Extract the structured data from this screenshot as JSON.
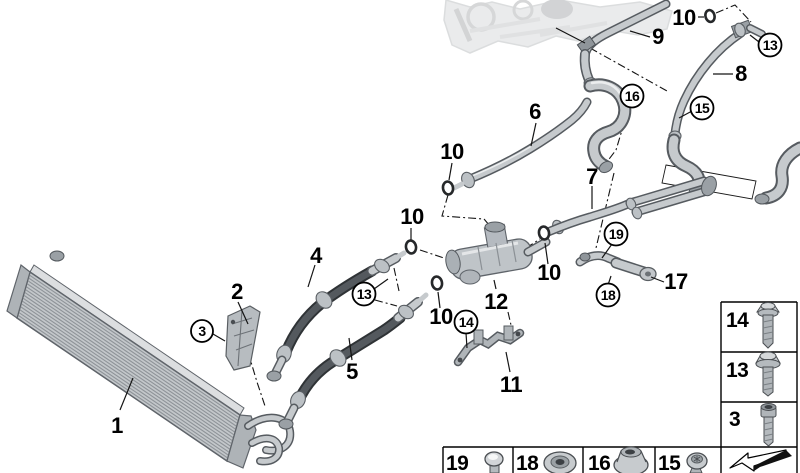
{
  "figure": {
    "kind": "vehicle-parts-exploded-diagram",
    "background_color": "#ffffff",
    "line_color": "#141414",
    "metal_color": "#c6cacd",
    "hose_color": "#54595e",
    "faded_engine_color": "#d6d8da"
  },
  "callouts": {
    "n1": "1",
    "n2": "2",
    "n4": "4",
    "n5": "5",
    "n6": "6",
    "n7": "7",
    "n8": "8",
    "n9": "9",
    "n10a": "10",
    "n10b": "10",
    "n10c": "10",
    "n10d": "10",
    "n10e": "10",
    "n11": "11",
    "n12": "12",
    "n17": "17",
    "c3": "3",
    "c13_hoses": "13",
    "c13_pipe8": "13",
    "c14": "14",
    "c15": "15",
    "c16": "16",
    "c18": "18",
    "c19": "19"
  },
  "legend": {
    "bottom_row": {
      "cell19": "19",
      "cell18": "18",
      "cell16": "16",
      "cell15": "15",
      "icons": {
        "cell19": "ball-stud-screw-icon",
        "cell18": "rubber-grommet-icon",
        "cell16": "flange-nut-icon",
        "cell15": "torx-screw-icon"
      }
    },
    "side_column": {
      "cell14": "14",
      "cell13": "13",
      "cell3": "3",
      "icons": {
        "cell14": "hex-flange-bolt-icon",
        "cell13": "hex-flange-bolt-washer-icon",
        "cell3": "socket-head-bolt-icon"
      }
    },
    "corner_symbol": "page-fold-arrow-icon"
  }
}
